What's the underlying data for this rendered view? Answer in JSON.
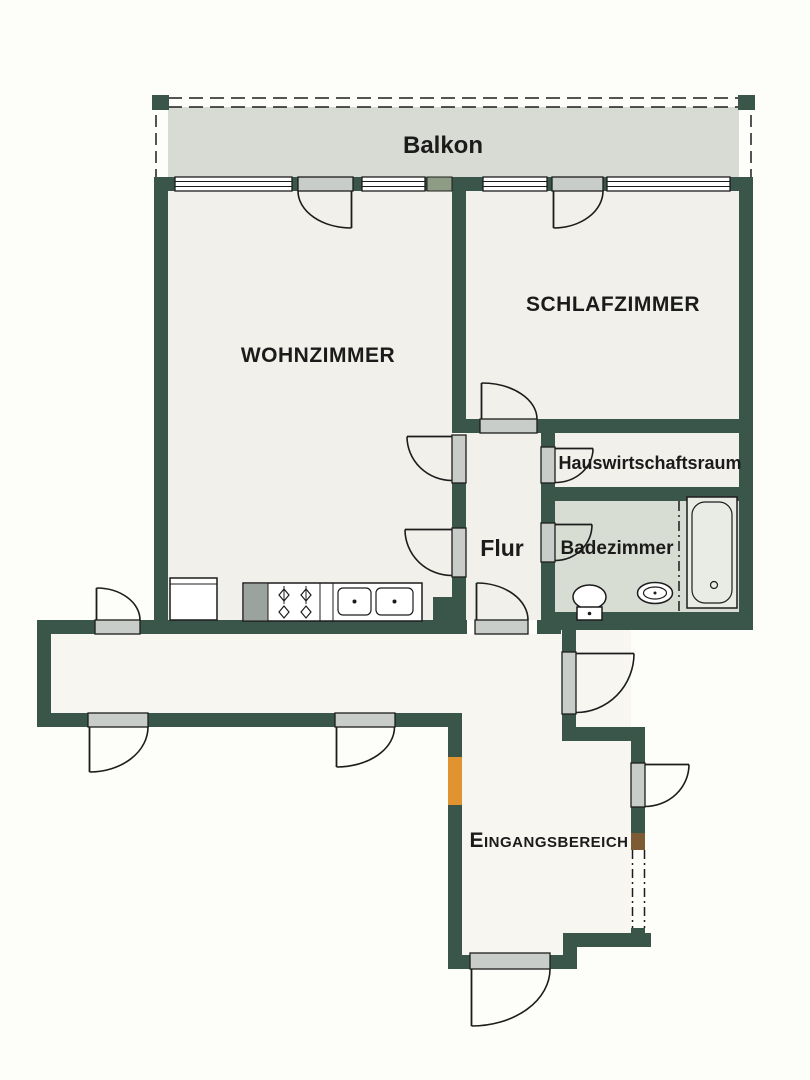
{
  "document": {
    "type": "apartment-floor-plan"
  },
  "labels": {
    "balkon": "Balkon",
    "wohnzimmer": "WOHNZIMMER",
    "schlafzimmer": "SCHLAFZIMMER",
    "hauswirtschaftsraum": "Hauswirtschaftsraum",
    "flur": "Flur",
    "badezimmer": "Badezimmer",
    "eingangsbereich": "Eingangsbereich"
  },
  "fixtures": [
    "bathtub",
    "washbasin",
    "toilet",
    "kitchen-counter",
    "stove-burners",
    "double-sink",
    "fridge"
  ],
  "colors": {
    "wall": "#3a564b",
    "wall_outline": "#22352d",
    "room": "#f1f0ea",
    "corridor": "#f7f6f1",
    "outside": "#fdfdfa",
    "balcony": "#d8dbd4",
    "bathroom": "#d7ddd3",
    "door_panel": "#c9cdc9",
    "fixture_fill": "#ffffff",
    "tub_fill": "#e9ece5",
    "counter_gray": "#9aa39e",
    "accent_orange": "#e0932f",
    "accent_brown": "#7d5c35",
    "accent_olive": "#8f9c85",
    "line": "#1c1c1c",
    "label": "#1b1b1b"
  }
}
